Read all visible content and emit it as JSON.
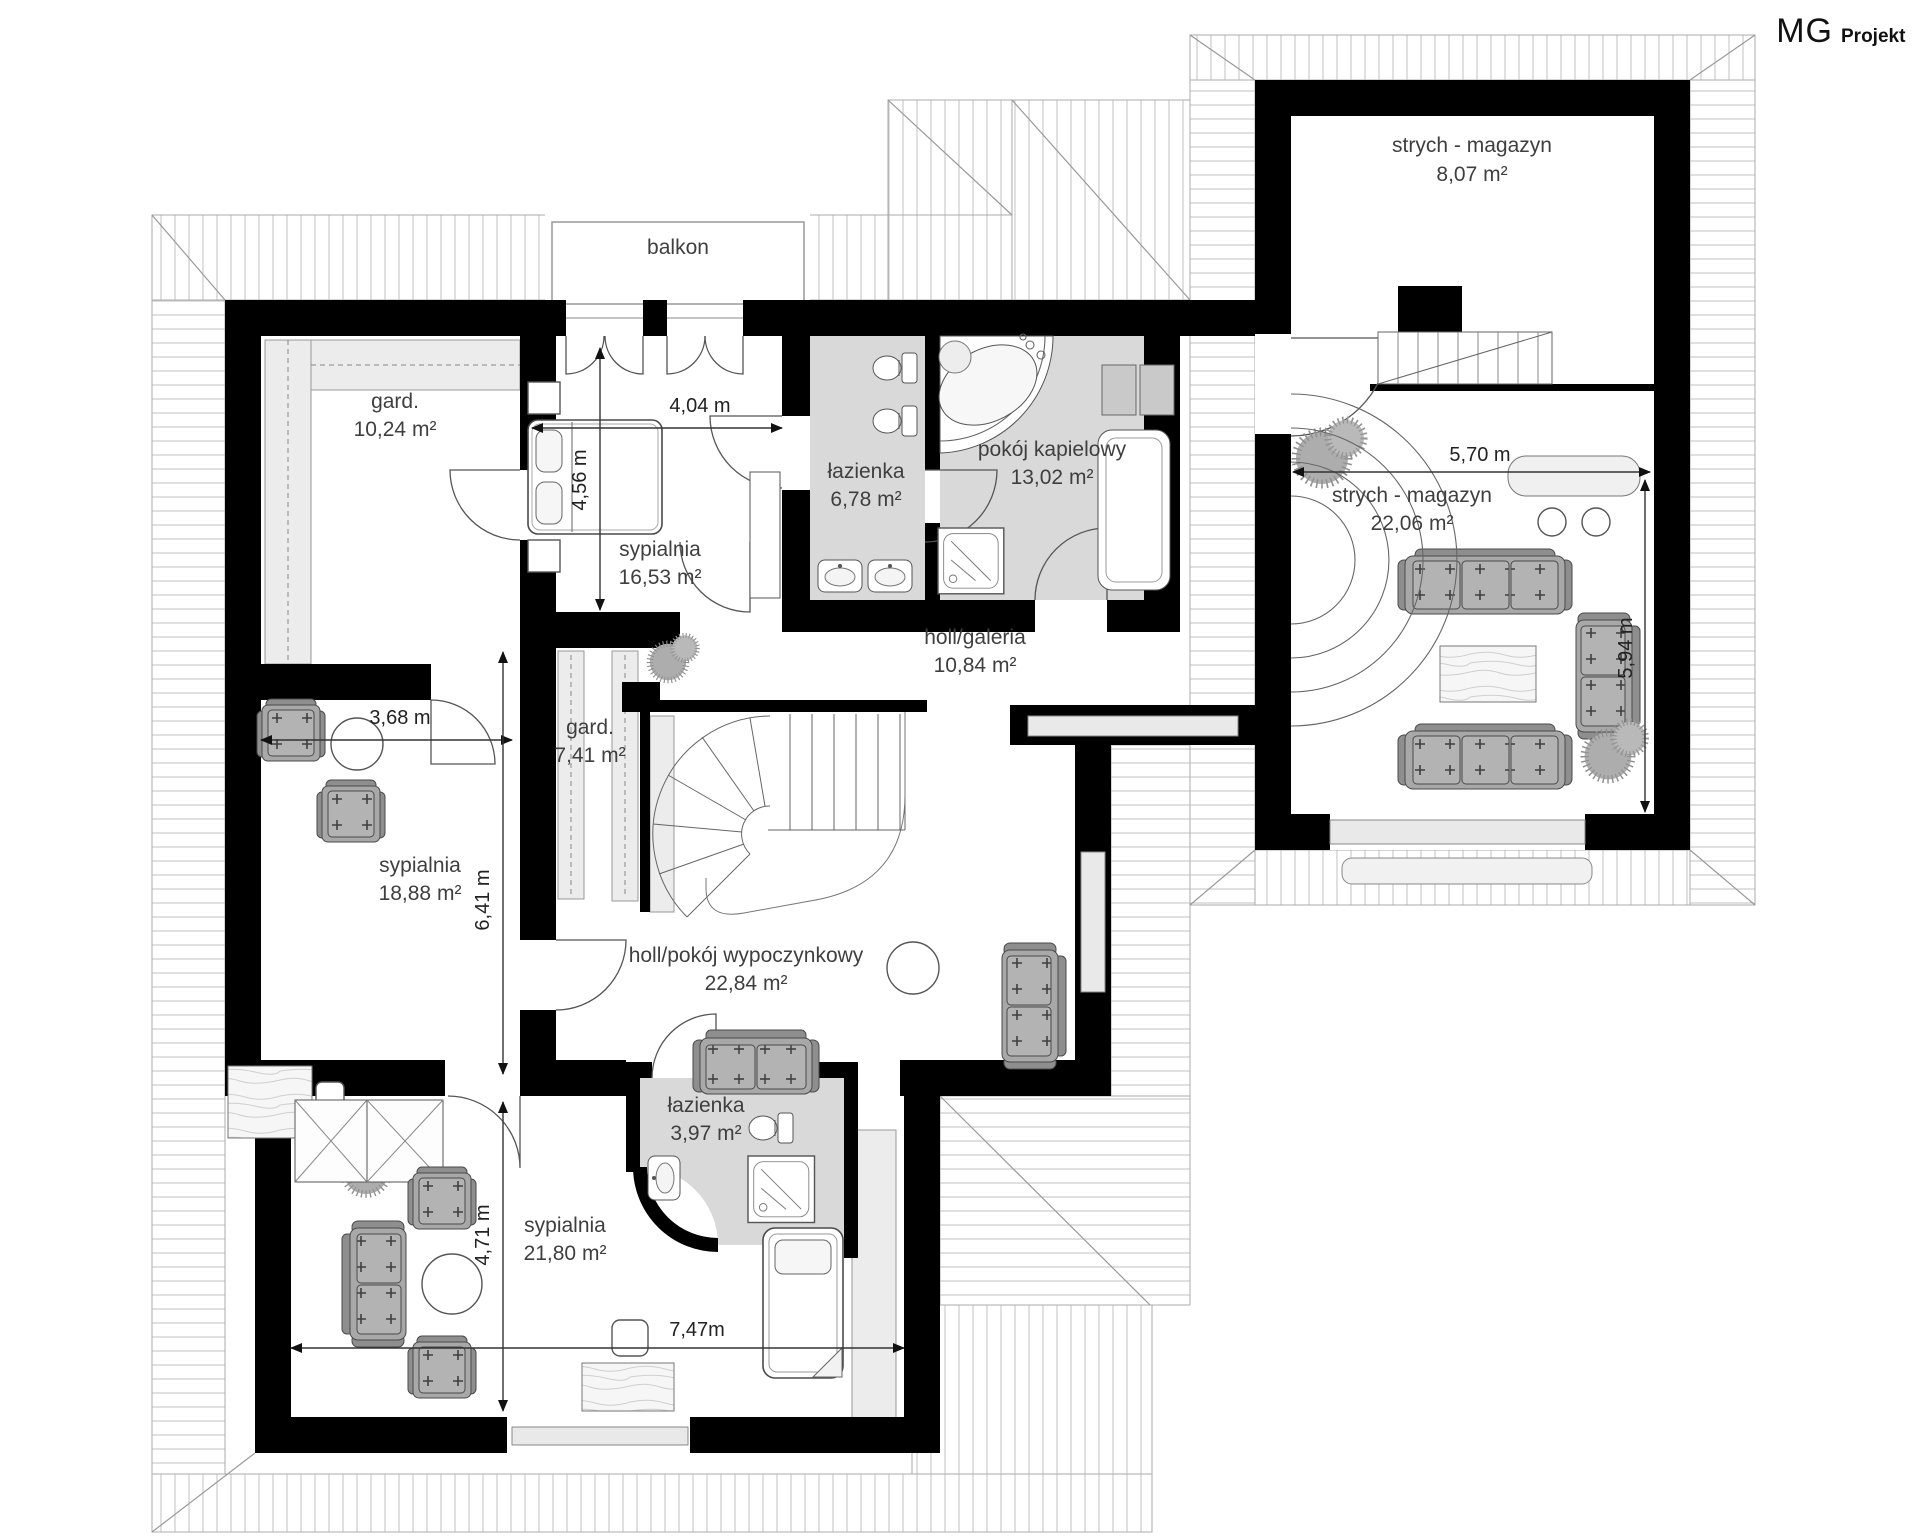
{
  "logo": {
    "mg": "MG",
    "projekt": "Projekt"
  },
  "rooms": {
    "strych_small": {
      "name": "strych - magazyn",
      "area": "8,07 m²"
    },
    "balkon": {
      "name": "balkon"
    },
    "gard_large": {
      "name": "gard.",
      "area": "10,24 m²"
    },
    "sypialnia_16": {
      "name": "sypialnia",
      "area": "16,53 m²"
    },
    "lazienka_6": {
      "name": "łazienka",
      "area": "6,78 m²"
    },
    "pokoj_kapielowy": {
      "name": "pokój kapielowy",
      "area": "13,02 m²"
    },
    "strych_large": {
      "name": "strych - magazyn",
      "area": "22,06 m²"
    },
    "holl_galeria": {
      "name": "holl/galeria",
      "area": "10,84 m²"
    },
    "gard_small": {
      "name": "gard.",
      "area": "7,41 m²"
    },
    "sypialnia_18": {
      "name": "sypialnia",
      "area": "18,88 m²"
    },
    "holl_wypoczynkowy": {
      "name": "holl/pokój wypoczynkowy",
      "area": "22,84 m²"
    },
    "lazienka_3": {
      "name": "łazienka",
      "area": "3,97 m²"
    },
    "sypialnia_21": {
      "name": "sypialnia",
      "area": "21,80 m²"
    }
  },
  "dimensions": {
    "d404": "4,04 m",
    "d456": "4,56 m",
    "d368": "3,68 m",
    "d641": "6,41 m",
    "d471": "4,71 m",
    "d747": "7,47m",
    "d570": "5,70 m",
    "d594": "5,94 m"
  },
  "colors": {
    "wall": "#000000",
    "bath_floor": "#d9d9d9",
    "furniture": "#b3b3b3",
    "roof_hatch": "#c2c2c2"
  }
}
